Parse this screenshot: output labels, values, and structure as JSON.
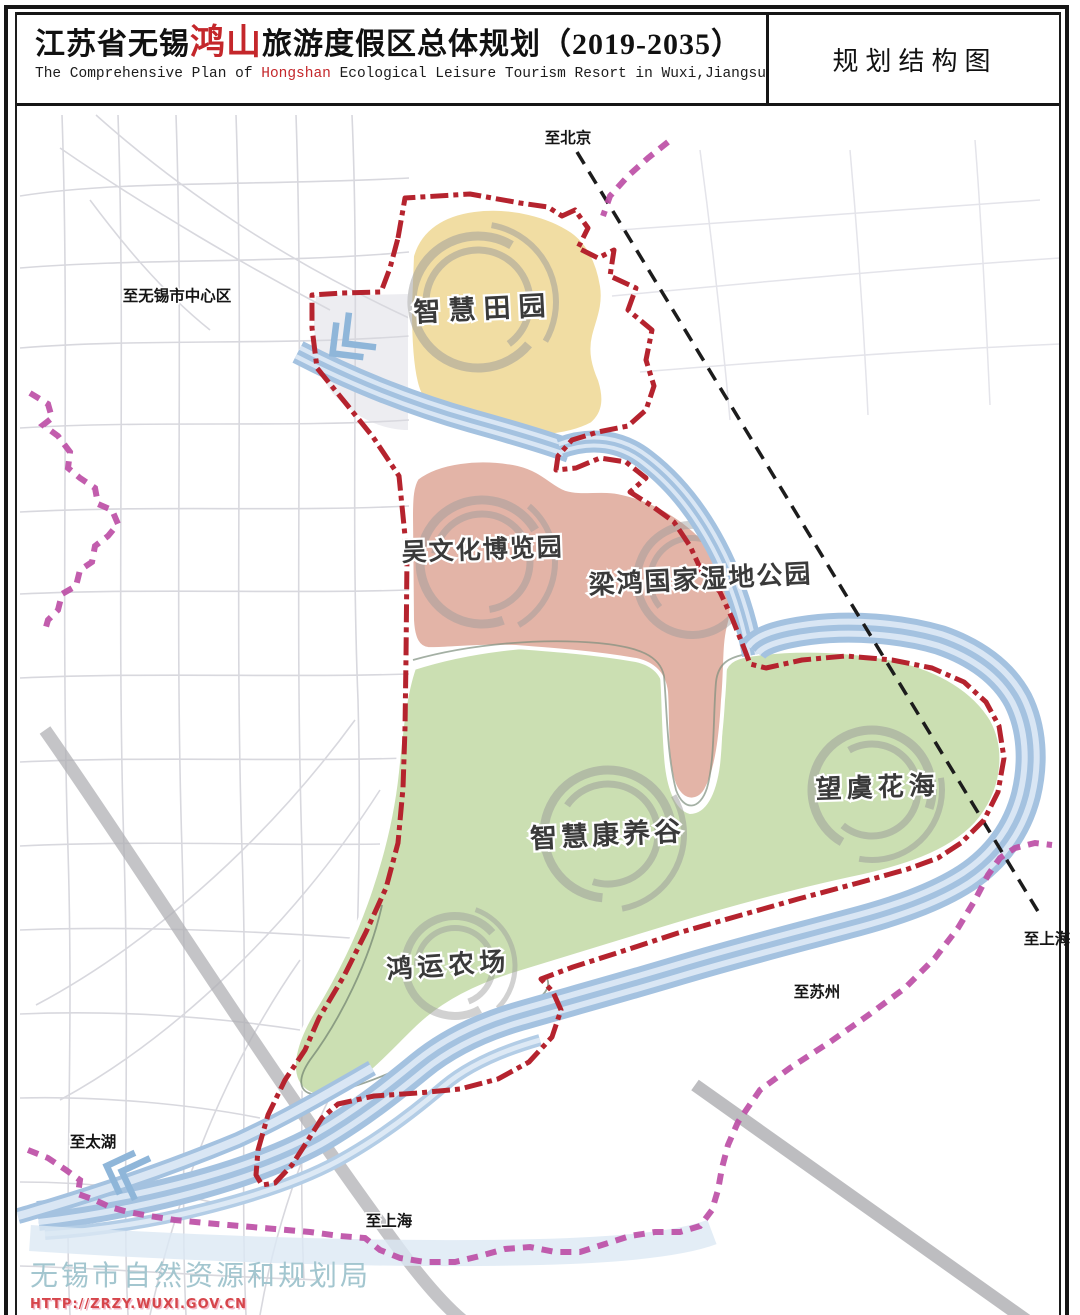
{
  "header": {
    "title_pre": "江苏省无锡",
    "title_highlight": "鸿山",
    "title_post": "旅游度假区总体规划（2019-2035）",
    "subtitle_pre": "The Comprehensive Plan of ",
    "subtitle_highlight": "Hongshan",
    "subtitle_post": " Ecological Leisure Tourism Resort in Wuxi,Jiangsu",
    "map_type_label": "规划结构图"
  },
  "map": {
    "zone_labels": {
      "smart_countryside": "智慧田园",
      "wu_culture_expo": "吴文化博览园",
      "lianghong_wetland": "梁鸿国家湿地公园",
      "smart_wellness_valley": "智慧康养谷",
      "wangyu_flower_sea": "望虞花海",
      "hongyun_farm": "鸿运农场"
    },
    "direction_labels": {
      "to_beijing": "至北京",
      "to_wuxi_center": "至无锡市中心区",
      "to_shanghai_rail": "至上海",
      "to_suzhou": "至苏州",
      "to_taihu": "至太湖",
      "to_shanghai_road": "至上海"
    },
    "colors": {
      "boundary_red": "#b5232e",
      "metro_magenta": "#bd4fa6",
      "railway_black": "#1c1c1c",
      "river_blue": "#a4c2e0",
      "river_light": "#d9e6f4",
      "zone_yellow": "#f1dda3",
      "zone_salmon": "#e3b4a7",
      "zone_green": "#cbdfb2",
      "swirl_gray": "#9a9a9a",
      "arrow_blue": "#8fb6d9"
    }
  },
  "footer": {
    "agency": "无锡市自然资源和规划局",
    "url": "HTTP://ZRZY.WUXI.GOV.CN"
  }
}
